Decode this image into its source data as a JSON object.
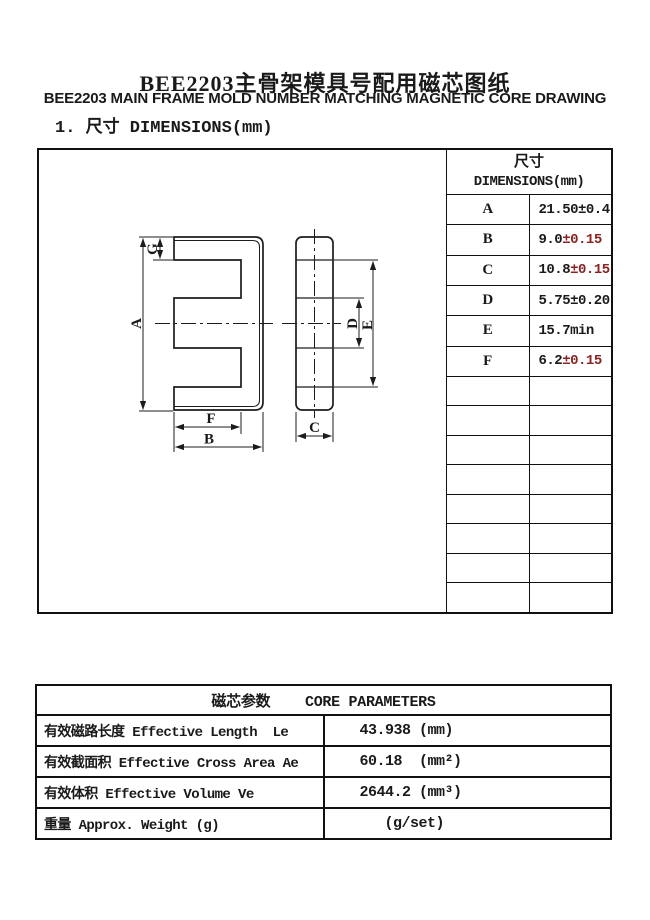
{
  "title": "BEE2203主骨架模具号配用磁芯图纸",
  "subtitle": "BEE2203 MAIN FRAME MOLD NUMBER MATCHING MAGNETIC CORE DRAWING",
  "section1_heading": "1. 尺寸 DIMENSIONS(mm)",
  "drawing": {
    "labels": {
      "A": "A",
      "B": "B",
      "C": "C",
      "D": "D",
      "E": "E",
      "F": "F",
      "G": "G"
    }
  },
  "dim_table": {
    "header_cn": "尺寸",
    "header_en": "DIMENSIONS(mm)",
    "rows": [
      {
        "label": "A",
        "value": "21.50±0.4",
        "tol": ""
      },
      {
        "label": "B",
        "value": "9.0",
        "tol": "±0.15"
      },
      {
        "label": "C",
        "value": "10.8",
        "tol": "±0.15"
      },
      {
        "label": "D",
        "value": "5.75±0.20",
        "tol": ""
      },
      {
        "label": "E",
        "value": "15.7min",
        "tol": ""
      },
      {
        "label": "F",
        "value": "6.2",
        "tol": "±0.15"
      }
    ]
  },
  "core_params": {
    "header": "磁芯参数    CORE PARAMETERS",
    "rows": [
      {
        "name": "有效磁路长度 Effective Length  Le",
        "value": "43.938 (mm)"
      },
      {
        "name": "有效截面积 Effective Cross Area Ae",
        "value": "60.18  (mm²)"
      },
      {
        "name": "有效体积 Effective Volume Ve",
        "value": "2644.2 (mm³)"
      },
      {
        "name": "重量 Approx. Weight (g)",
        "value": "(g/set)"
      }
    ]
  },
  "colors": {
    "tolerance_red": "#8b2323",
    "ink": "#1a1a1a"
  }
}
